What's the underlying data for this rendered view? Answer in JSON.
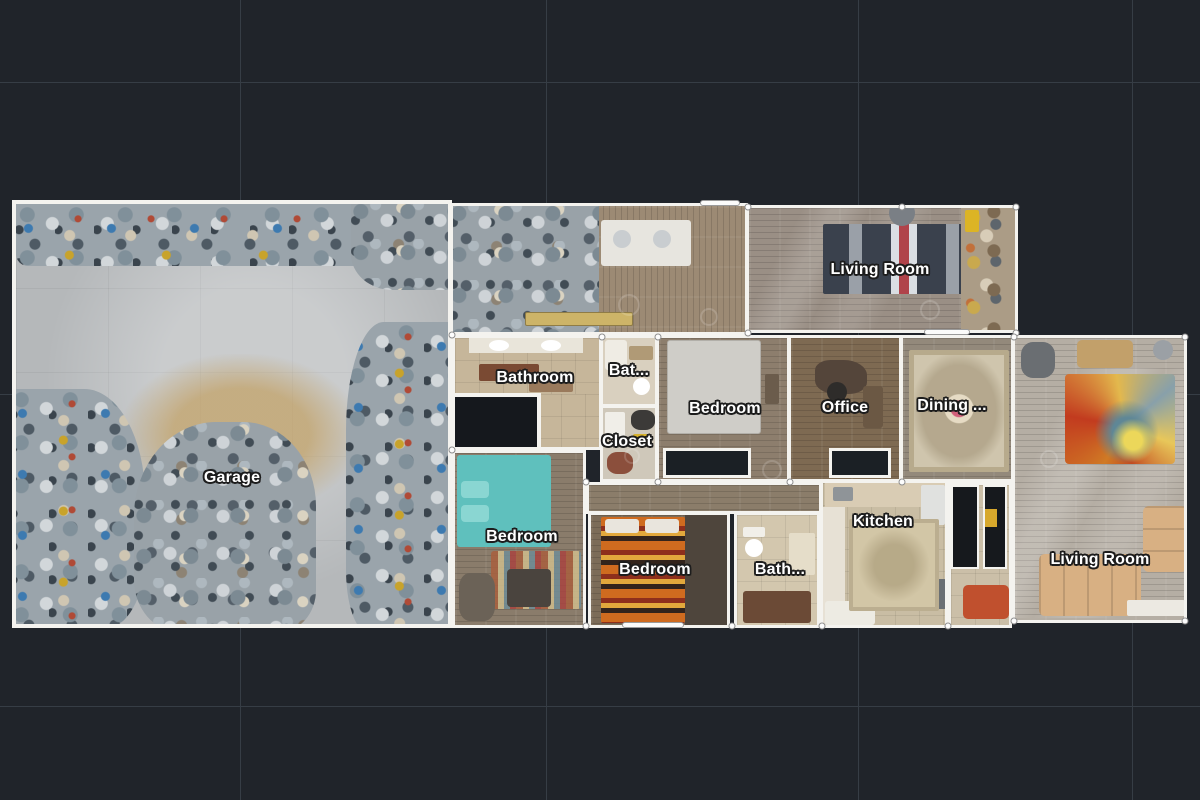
{
  "view": {
    "description": "top-down floor plan view"
  },
  "colors": {
    "background": "#20242a",
    "grid": "#363d45",
    "wall": "#f4f3ef",
    "label_text": "#ffffff",
    "label_outline": "#1d1d1d"
  },
  "rooms": [
    {
      "id": "living-room-top",
      "label": "Living Room"
    },
    {
      "id": "bathroom",
      "label": "Bathroom"
    },
    {
      "id": "bathroom-small-top",
      "label": "Bat..."
    },
    {
      "id": "bedroom-middle",
      "label": "Bedroom"
    },
    {
      "id": "office",
      "label": "Office"
    },
    {
      "id": "dining-room",
      "label": "Dining ..."
    },
    {
      "id": "closet",
      "label": "Closet"
    },
    {
      "id": "garage",
      "label": "Garage"
    },
    {
      "id": "bedroom-bottom-left",
      "label": "Bedroom"
    },
    {
      "id": "bedroom-bottom-middle",
      "label": "Bedroom"
    },
    {
      "id": "bathroom-small-bottom",
      "label": "Bath..."
    },
    {
      "id": "kitchen",
      "label": "Kitchen"
    },
    {
      "id": "living-room-bottom",
      "label": "Living Room"
    }
  ]
}
